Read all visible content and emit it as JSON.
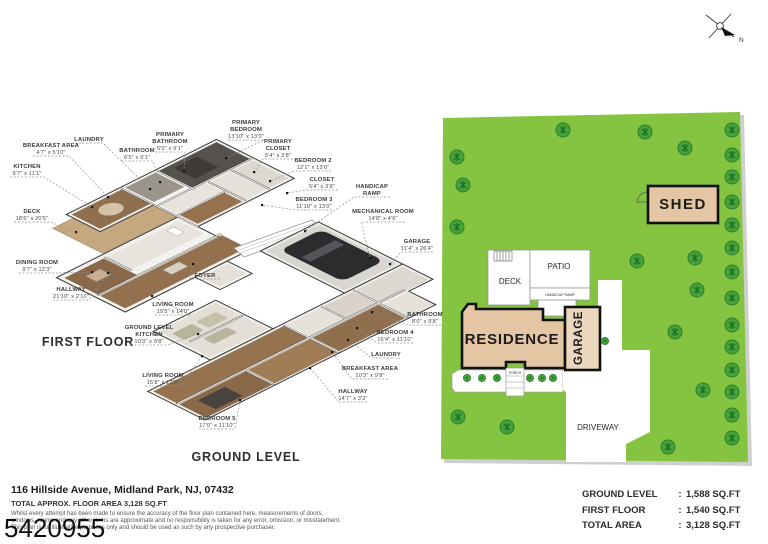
{
  "first_floor": {
    "title": "FIRST FLOOR",
    "labels": [
      {
        "l1": "BREAKFAST AREA",
        "l2": "4'7\" x 5'10\""
      },
      {
        "l1": "LAUNDRY"
      },
      {
        "l1": "BATHROOM",
        "l2": "6'5\" x 9'1\""
      },
      {
        "l1": "PRIMARY",
        "l2": "BATHROOM",
        "l3": "5'0\" x 9'1\""
      },
      {
        "l1": "PRIMARY",
        "l2": "BEDROOM",
        "l3": "13'10\" x 13'0\""
      },
      {
        "l1": "PRIMARY",
        "l2": "CLOSET",
        "l3": "5'4\" x 3'8\""
      },
      {
        "l1": "KITCHEN",
        "l2": "9'7\" x 11'1\""
      },
      {
        "l1": "BEDROOM 2",
        "l2": "12'1\" x 13'0\""
      },
      {
        "l1": "CLOSET",
        "l2": "5'4\" x 3'8\""
      },
      {
        "l1": "DECK",
        "l2": "18'6\" x 20'5\""
      },
      {
        "l1": "BEDROOM 3",
        "l2": "11'10\" x 13'0\""
      },
      {
        "l1": "DINING ROOM",
        "l2": "9'7\" x 12'3\""
      },
      {
        "l1": "FOYER"
      },
      {
        "l1": "HALLWAY",
        "l2": "21'10\" x 2'10\""
      },
      {
        "l1": "LIVING ROOM",
        "l2": "19'5\" x 14'0\""
      }
    ]
  },
  "ground_level": {
    "title": "GROUND LEVEL",
    "labels": [
      {
        "l1": "HANDICAP",
        "l2": "RAMP"
      },
      {
        "l1": "MECHANICAL ROOM",
        "l2": "14'8\" x 4'6\""
      },
      {
        "l1": "GARAGE",
        "l2": "11'4\" x 26'4\""
      },
      {
        "l1": "BATHROOM",
        "l2": "8'0\" x 9'8\""
      },
      {
        "l1": "BEDROOM 4",
        "l2": "16'4\" x 11'10\""
      },
      {
        "l1": "LAUNDRY"
      },
      {
        "l1": "BREAKFAST AREA",
        "l2": "10'3\" x 9'8\""
      },
      {
        "l1": "HALLWAY",
        "l2": "14'7\" x 3'3\""
      },
      {
        "l1": "GROUND LEVEL",
        "l2": "KITCHEN",
        "l3": "10'3\" x 9'8\""
      },
      {
        "l1": "LIVING ROOM",
        "l2": "15'8\" x 12'6\""
      },
      {
        "l1": "BEDROOM 5",
        "l2": "17'0\" x 11'10\""
      }
    ]
  },
  "site_plan": {
    "shed_label": "SHED",
    "deck_label": "DECK",
    "patio_label": "PATIO",
    "handicap_ramp_label": "HANDICAP RAMP",
    "residence_label": "RESIDENCE",
    "garage_label": "GARAGE",
    "porch_label": "PORCH",
    "driveway_label": "DRIVEWAY",
    "compass_north": "N",
    "colors": {
      "grass": "#84c441",
      "tree": "#45a339",
      "building": "#e5c6a4",
      "hardscape": "#ffffff"
    }
  },
  "footer": {
    "address": "116 Hillside Avenue, Midland Park, NJ, 07432",
    "total_line": "TOTAL APPROX. FLOOR AREA 3,128 SQ.FT",
    "disclaimer_l1": "Whilst every attempt has been made to ensure the accuracy of the floor plan contained here, measurements of doors,",
    "disclaimer_l2": "windows, rooms and any other items are approximate and no responsibility is taken for any error, omission, or misstatement.",
    "disclaimer_l3": "This plan is for illustrative purposes only and should be used as such by any prospective purchaser.",
    "plan_id": "5420955"
  },
  "area_summary": {
    "rows": [
      {
        "label": "GROUND LEVEL",
        "sep": ":",
        "value": "1,588 SQ.FT"
      },
      {
        "label": "FIRST FLOOR",
        "sep": ":",
        "value": "1,540 SQ.FT"
      },
      {
        "label": "TOTAL AREA",
        "sep": ":",
        "value": "3,128 SQ.FT"
      }
    ]
  }
}
